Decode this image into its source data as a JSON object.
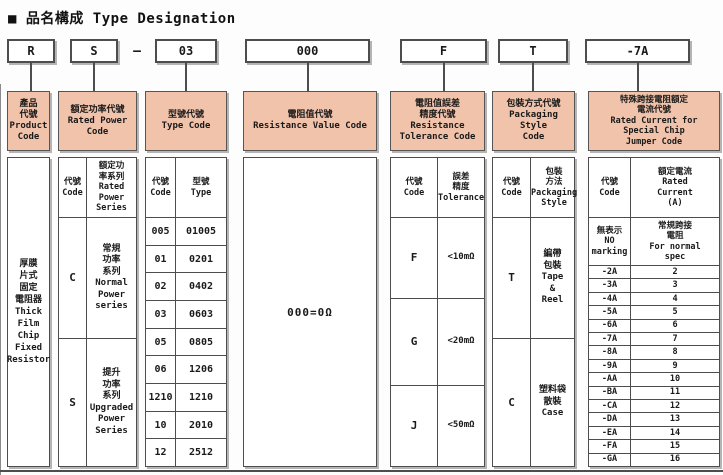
{
  "title": "■ 品名構成  Type Designation",
  "top_codes": {
    "product": "R",
    "power": "S",
    "dash": "–",
    "type": "03",
    "value": "000",
    "tolerance": "F",
    "packaging": "T",
    "jumper": "-7A"
  },
  "columns": {
    "product": {
      "header": "產品\n代號\nProduct\nCode",
      "body": "厚膜\n片式\n固定\n電阻器\nThick\nFilm\nChip\nFixed\nResistor"
    },
    "power": {
      "header": "額定功率代號\nRated Power\nCode",
      "sub_code": "代號\nCode",
      "sub_label": "額定功\n率系列\nRated\nPower\nSeries",
      "rows": [
        {
          "code": "C",
          "label": "常規\n功率\n系列\nNormal\nPower\nseries"
        },
        {
          "code": "S",
          "label": "提升\n功率\n系列\nUpgraded\nPower\nSeries"
        }
      ]
    },
    "type": {
      "header": "型號代號\nType Code",
      "sub_code": "代號\nCode",
      "sub_label": "型號\nType",
      "rows": [
        [
          "005",
          "01005"
        ],
        [
          "01",
          "0201"
        ],
        [
          "02",
          "0402"
        ],
        [
          "03",
          "0603"
        ],
        [
          "05",
          "0805"
        ],
        [
          "06",
          "1206"
        ],
        [
          "1210",
          "1210"
        ],
        [
          "10",
          "2010"
        ],
        [
          "12",
          "2512"
        ]
      ]
    },
    "value": {
      "header": "電阻值代號\nResistance Value Code",
      "body": "000=0Ω"
    },
    "tolerance": {
      "header": "電阻值誤差\n精度代號\nResistance\nTolerance Code",
      "sub_code": "代號\nCode",
      "sub_label": "誤差\n精度\nTolerance",
      "rows": [
        [
          "F",
          "<10mΩ"
        ],
        [
          "G",
          "<20mΩ"
        ],
        [
          "J",
          "<50mΩ"
        ]
      ]
    },
    "packaging": {
      "header": "包裝方式代號\nPackaging Style\nCode",
      "sub_code": "代號\nCode",
      "sub_label": "包裝\n方法\nPackaging\nStyle",
      "rows": [
        {
          "code": "T",
          "label": "編帶\n包裝\nTape\n&\nReel"
        },
        {
          "code": "C",
          "label": "塑料袋\n散裝\nCase"
        }
      ]
    },
    "jumper": {
      "header": "特殊跨接電阻額定\n電流代號\nRated Current for\nSpecial Chip\nJumper Code",
      "sub_code": "代號\nCode",
      "sub_label": "額定電流\nRated\nCurrent\n(A)",
      "special_code": "無表示\nNO\nmarking",
      "special_label": "常規跨接\n電阻\nFor normal\nspec",
      "rows": [
        [
          "-2A",
          "2"
        ],
        [
          "-3A",
          "3"
        ],
        [
          "-4A",
          "4"
        ],
        [
          "-5A",
          "5"
        ],
        [
          "-6A",
          "6"
        ],
        [
          "-7A",
          "7"
        ],
        [
          "-8A",
          "8"
        ],
        [
          "-9A",
          "9"
        ],
        [
          "-AA",
          "10"
        ],
        [
          "-BA",
          "11"
        ],
        [
          "-CA",
          "12"
        ],
        [
          "-DA",
          "13"
        ],
        [
          "-EA",
          "14"
        ],
        [
          "-FA",
          "15"
        ],
        [
          "-GA",
          "16"
        ]
      ]
    }
  },
  "colors": {
    "header_bg": "#f1c3ab",
    "border": "#4d4d4d",
    "shadow": "#b5b5b5"
  }
}
